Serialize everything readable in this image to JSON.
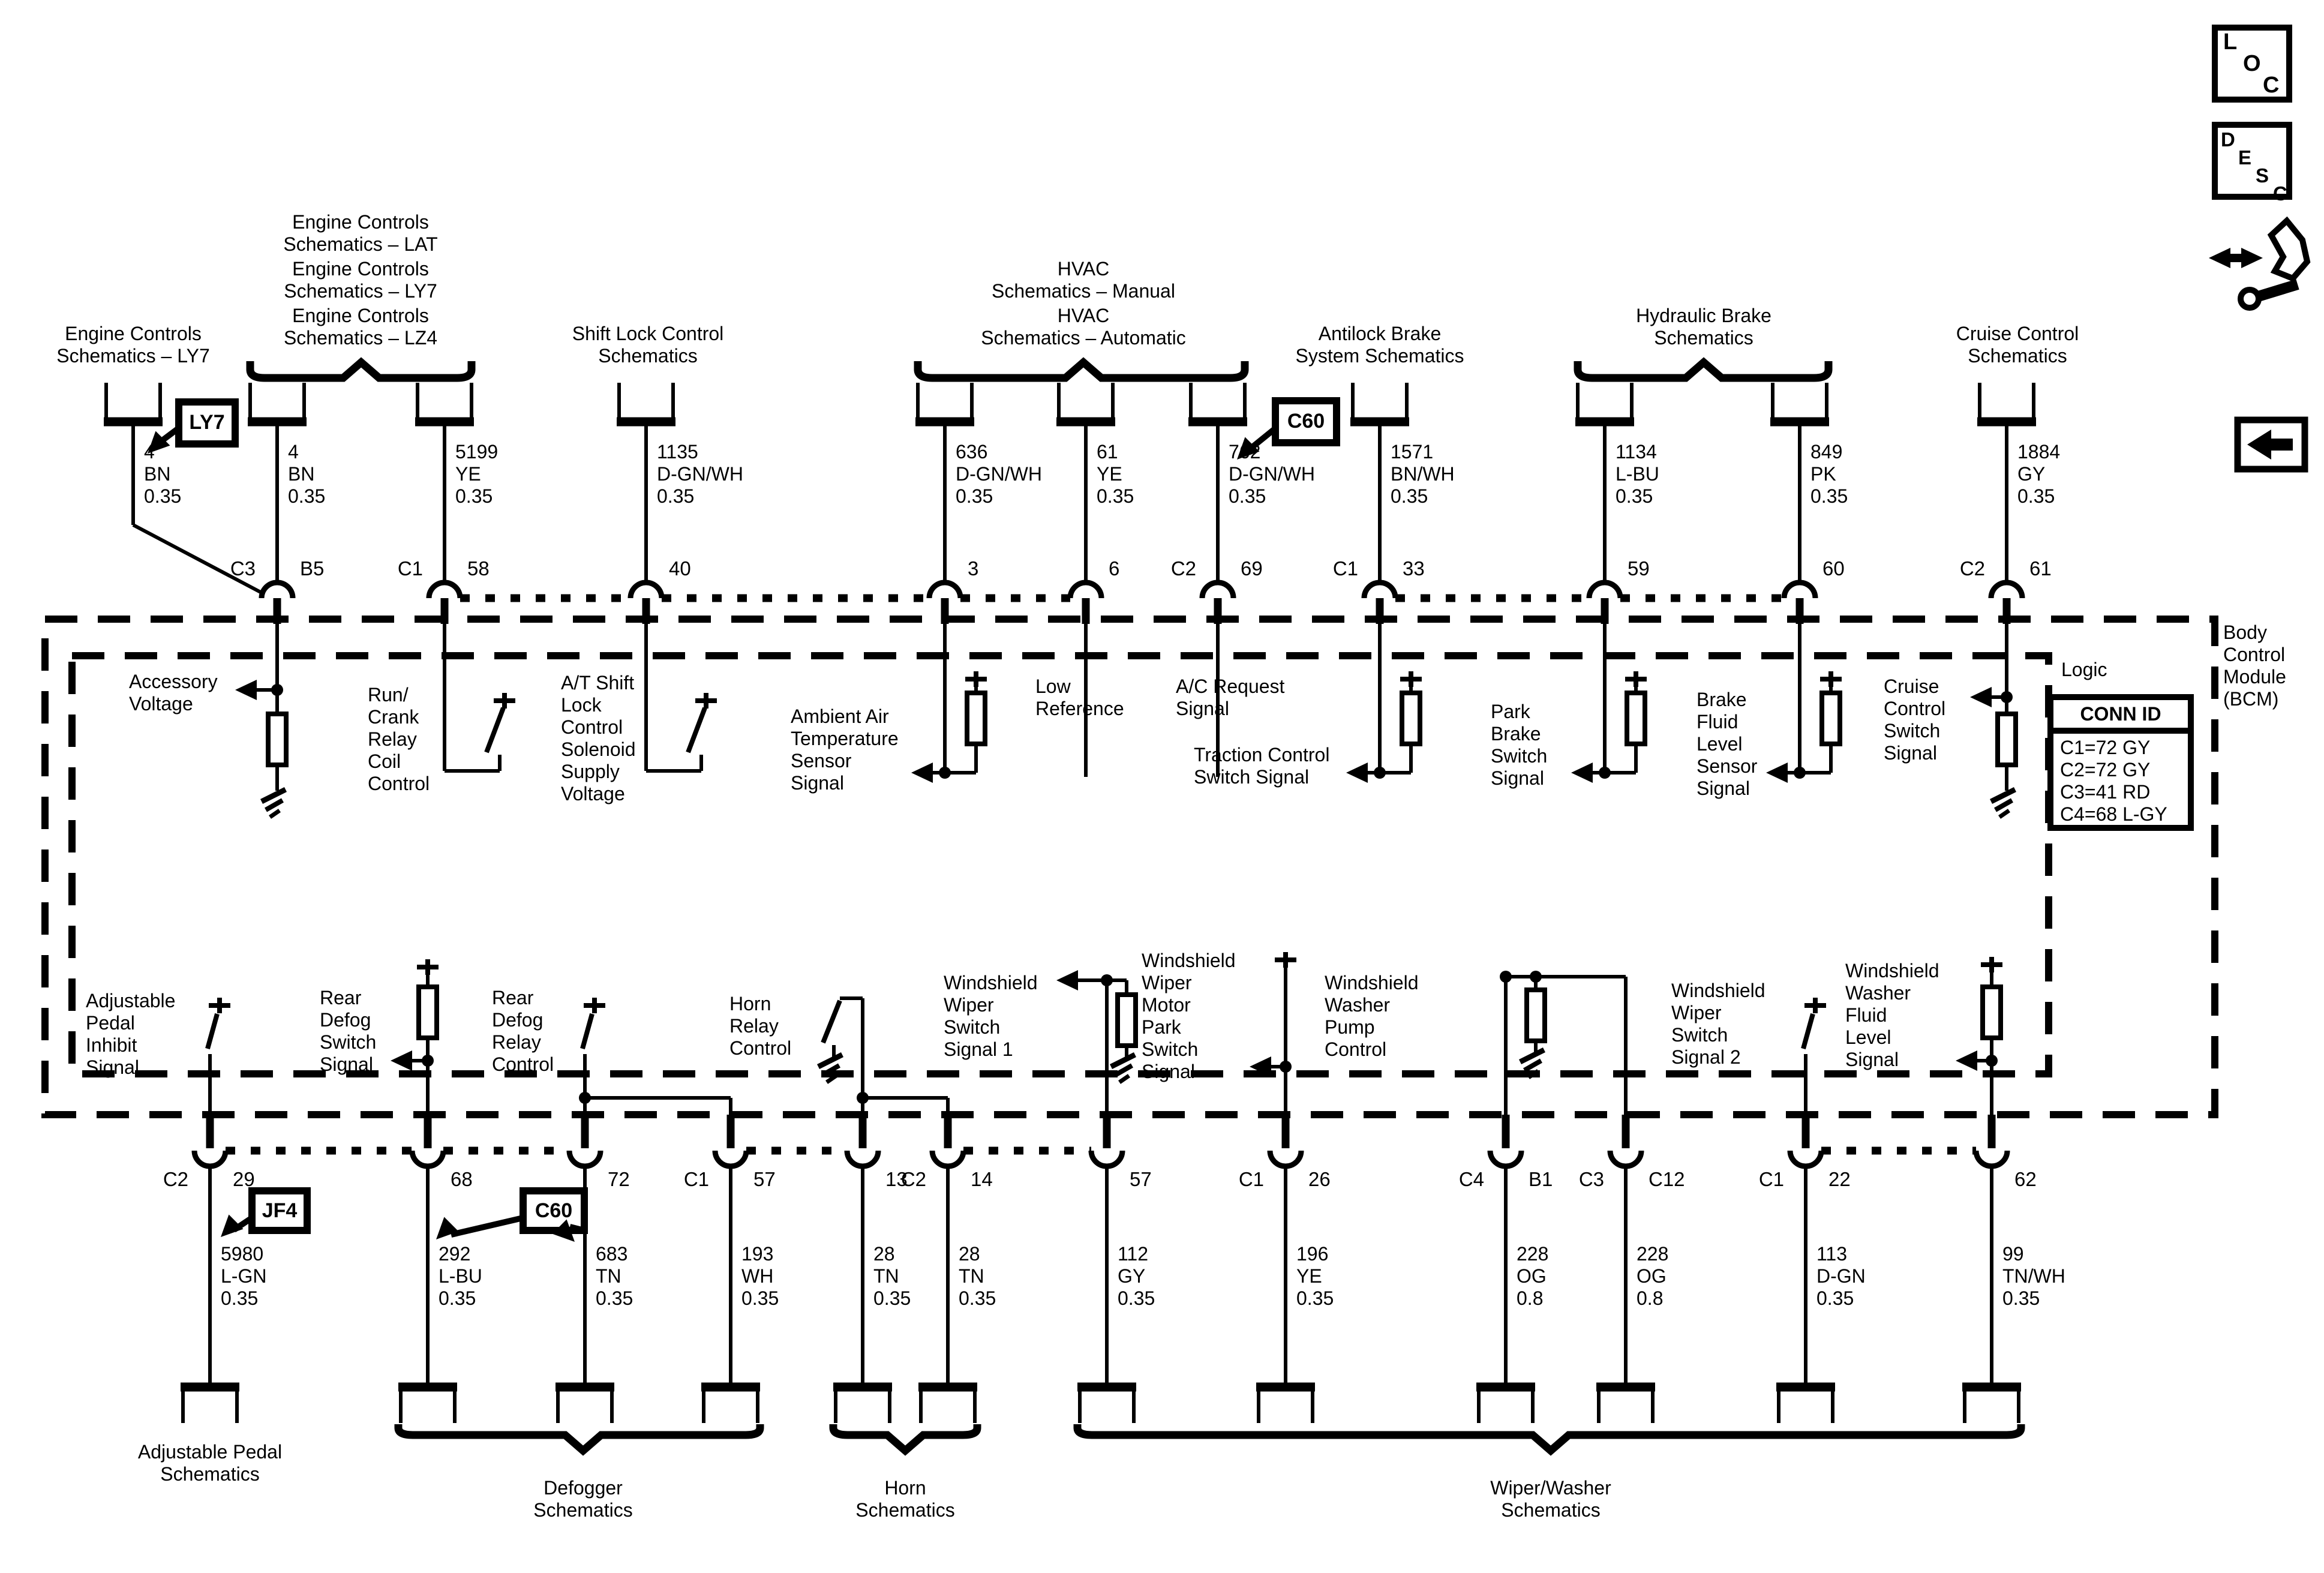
{
  "titles": {
    "eng_ly7": "Engine Controls\nSchematics – LY7",
    "eng_lat": "Engine Controls\nSchematics – LAT",
    "eng_ly7b": "Engine Controls\nSchematics – LY7",
    "eng_lz4": "Engine Controls\nSchematics – LZ4",
    "shift_lock": "Shift Lock Control\nSchematics",
    "hvac_manual": "HVAC\nSchematics – Manual",
    "hvac_auto": "HVAC\nSchematics – Automatic",
    "abs": "Antilock Brake\nSystem Schematics",
    "hyd_brake": "Hydraulic Brake\nSchematics",
    "cruise": "Cruise Control\nSchematics"
  },
  "top_wires": [
    "4\nBN\n0.35",
    "4\nBN\n0.35",
    "5199\nYE\n0.35",
    "1135\nD-GN/WH\n0.35",
    "636\nD-GN/WH\n0.35",
    "61\nYE\n0.35",
    "762\nD-GN/WH\n0.35",
    "1571\nBN/WH\n0.35",
    "1134\nL-BU\n0.35",
    "849\nPK\n0.35",
    "1884\nGY\n0.35"
  ],
  "top_pins": [
    {
      "l": "C3",
      "r": "B5"
    },
    {
      "l": "C1",
      "r": "58"
    },
    {
      "r": "40"
    },
    {
      "r": "3"
    },
    {
      "r": "6"
    },
    {
      "l": "C2",
      "r": "69"
    },
    {
      "l": "C1",
      "r": "33"
    },
    {
      "r": "59"
    },
    {
      "r": "60"
    },
    {
      "l": "C2",
      "r": "61"
    }
  ],
  "bottom_pins": [
    {
      "l": "C2",
      "r": "29"
    },
    {
      "r": "68"
    },
    {
      "r": "72"
    },
    {
      "l": "C1",
      "r": "57"
    },
    {
      "r": "13"
    },
    {
      "l": "C2",
      "r": "14"
    },
    {
      "r": "57"
    },
    {
      "l": "C1",
      "r": "26"
    },
    {
      "l": "C4",
      "r": "B1"
    },
    {
      "l": "C3",
      "r": "C12"
    },
    {
      "l": "C1",
      "r": "22"
    },
    {
      "r": "62"
    }
  ],
  "bottom_wires": [
    "5980\nL-GN\n0.35",
    "292\nL-BU\n0.35",
    "683\nTN\n0.35",
    "193\nWH\n0.35",
    "28\nTN\n0.35",
    "28\nTN\n0.35",
    "112\nGY\n0.35",
    "196\nYE\n0.35",
    "228\nOG\n0.8",
    "228\nOG\n0.8",
    "113\nD-GN\n0.35",
    "99\nTN/WH\n0.35"
  ],
  "signals": {
    "accessory": "Accessory\nVoltage",
    "run_crank": "Run/\nCrank\nRelay\nCoil\nControl",
    "at_shift": "A/T Shift\nLock\nControl\nSolenoid\nSupply\nVoltage",
    "ambient": "Ambient Air\nTemperature\nSensor\nSignal",
    "low_ref": "Low\nReference",
    "ac_request": "A/C Request\nSignal",
    "traction": "Traction Control\nSwitch Signal",
    "park_brake": "Park\nBrake\nSwitch\nSignal",
    "brake_fluid": "Brake\nFluid\nLevel\nSensor\nSignal",
    "cruise_sw": "Cruise\nControl\nSwitch\nSignal",
    "adj_pedal": "Adjustable\nPedal\nInhibit\nSignal",
    "rear_defog_sw": "Rear\nDefog\nSwitch\nSignal",
    "rear_defog_relay": "Rear\nDefog\nRelay\nControl",
    "horn_relay": "Horn\nRelay\nControl",
    "wiper_sw1": "Windshield\nWiper\nSwitch\nSignal 1",
    "wiper_park": "Windshield\nWiper\nMotor\nPark\nSwitch\nSignal",
    "washer_pump": "Windshield\nWasher\nPump\nControl",
    "wiper_sw2": "Windshield\nWiper\nSwitch\nSignal 2",
    "washer_fluid": "Windshield\nWasher\nFluid\nLevel\nSignal"
  },
  "module": {
    "name": "Body\nControl\nModule\n(BCM)",
    "logic": "Logic",
    "conn_id_title": "CONN ID",
    "conn_ids": "C1=72 GY\nC2=72 GY\nC3=41 RD\nC4=68 L-GY"
  },
  "callouts": {
    "ly7": "LY7",
    "c60_top": "C60",
    "jf4": "JF4",
    "c60_bottom": "C60"
  },
  "sections": {
    "adj_pedal": "Adjustable Pedal\nSchematics",
    "defogger": "Defogger\nSchematics",
    "horn": "Horn\nSchematics",
    "wiper": "Wiper/Washer\nSchematics"
  },
  "corner": {
    "loc": [
      "L",
      "O",
      "C"
    ],
    "desc": [
      "D",
      "E",
      "S",
      "C"
    ]
  },
  "colors": {
    "line": "#000000",
    "background": "#ffffff"
  }
}
